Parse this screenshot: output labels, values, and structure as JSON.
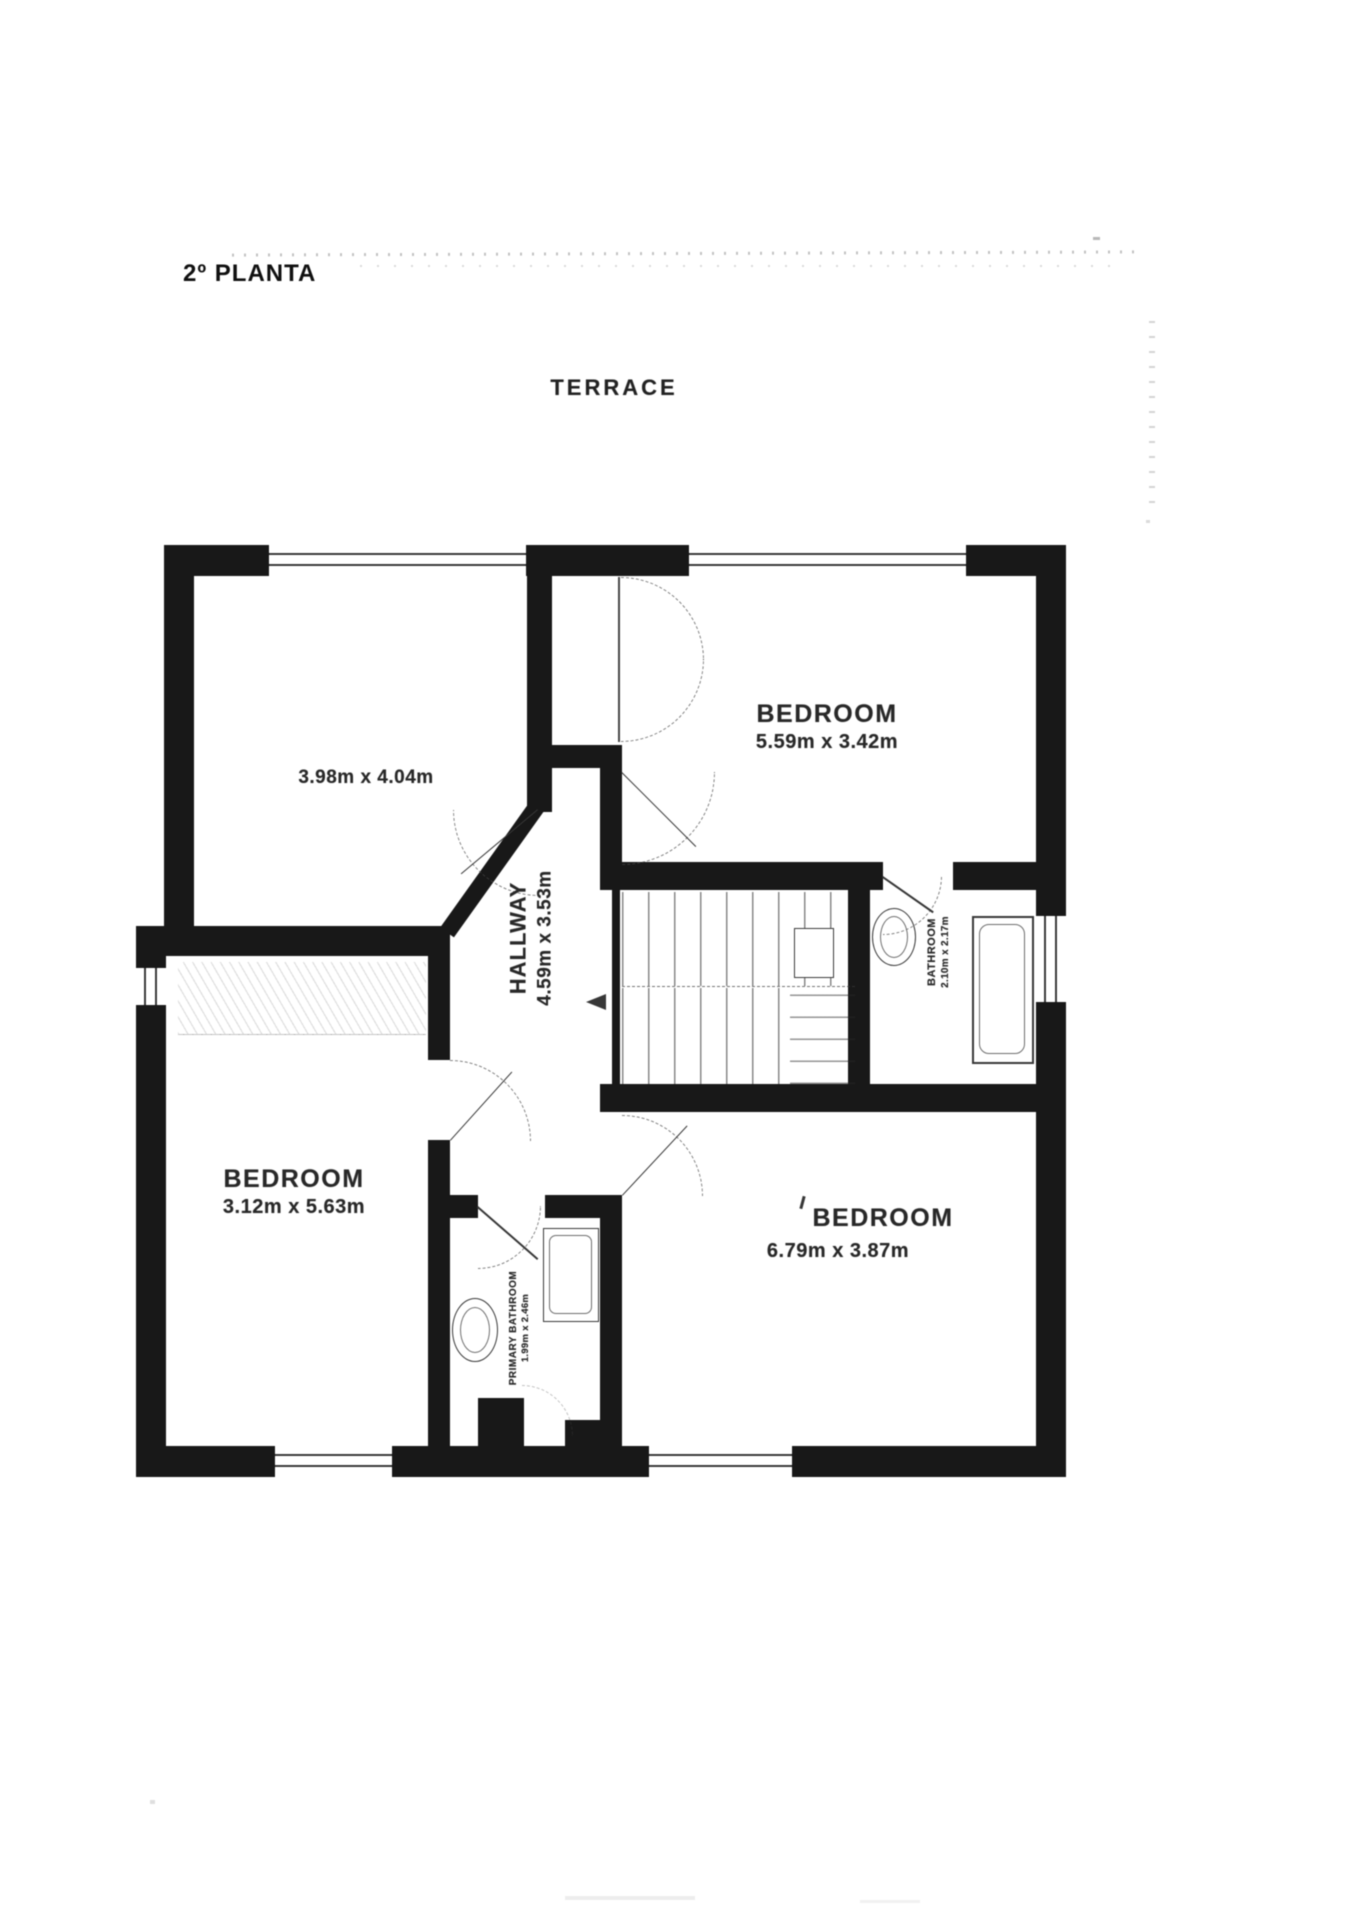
{
  "document": {
    "title": "2º PLANTA"
  },
  "floor_plan": {
    "terrace_label": "TERRACE",
    "rooms": {
      "top_left_room": {
        "dimensions": "3.98m x 4.04m"
      },
      "bedroom_top_right": {
        "name": "BEDROOM",
        "dimensions": "5.59m x 3.42m"
      },
      "hallway": {
        "name": "HALLWAY",
        "dimensions": "4.59m x 3.53m"
      },
      "bathroom": {
        "name": "BATHROOM",
        "dimensions": "2.10m x 2.17m"
      },
      "bedroom_left": {
        "name": "BEDROOM",
        "dimensions": "3.12m x 5.63m"
      },
      "bedroom_bottom_right": {
        "name": "BEDROOM",
        "dimensions": "6.79m x 3.87m"
      },
      "primary_bathroom": {
        "name": "PRIMARY BATHROOM",
        "dimensions": "1.99m x 2.46m"
      }
    },
    "colors": {
      "wall": "#1c1c1c",
      "label_text": "#2b2b2b",
      "paper": "#ffffff"
    }
  }
}
